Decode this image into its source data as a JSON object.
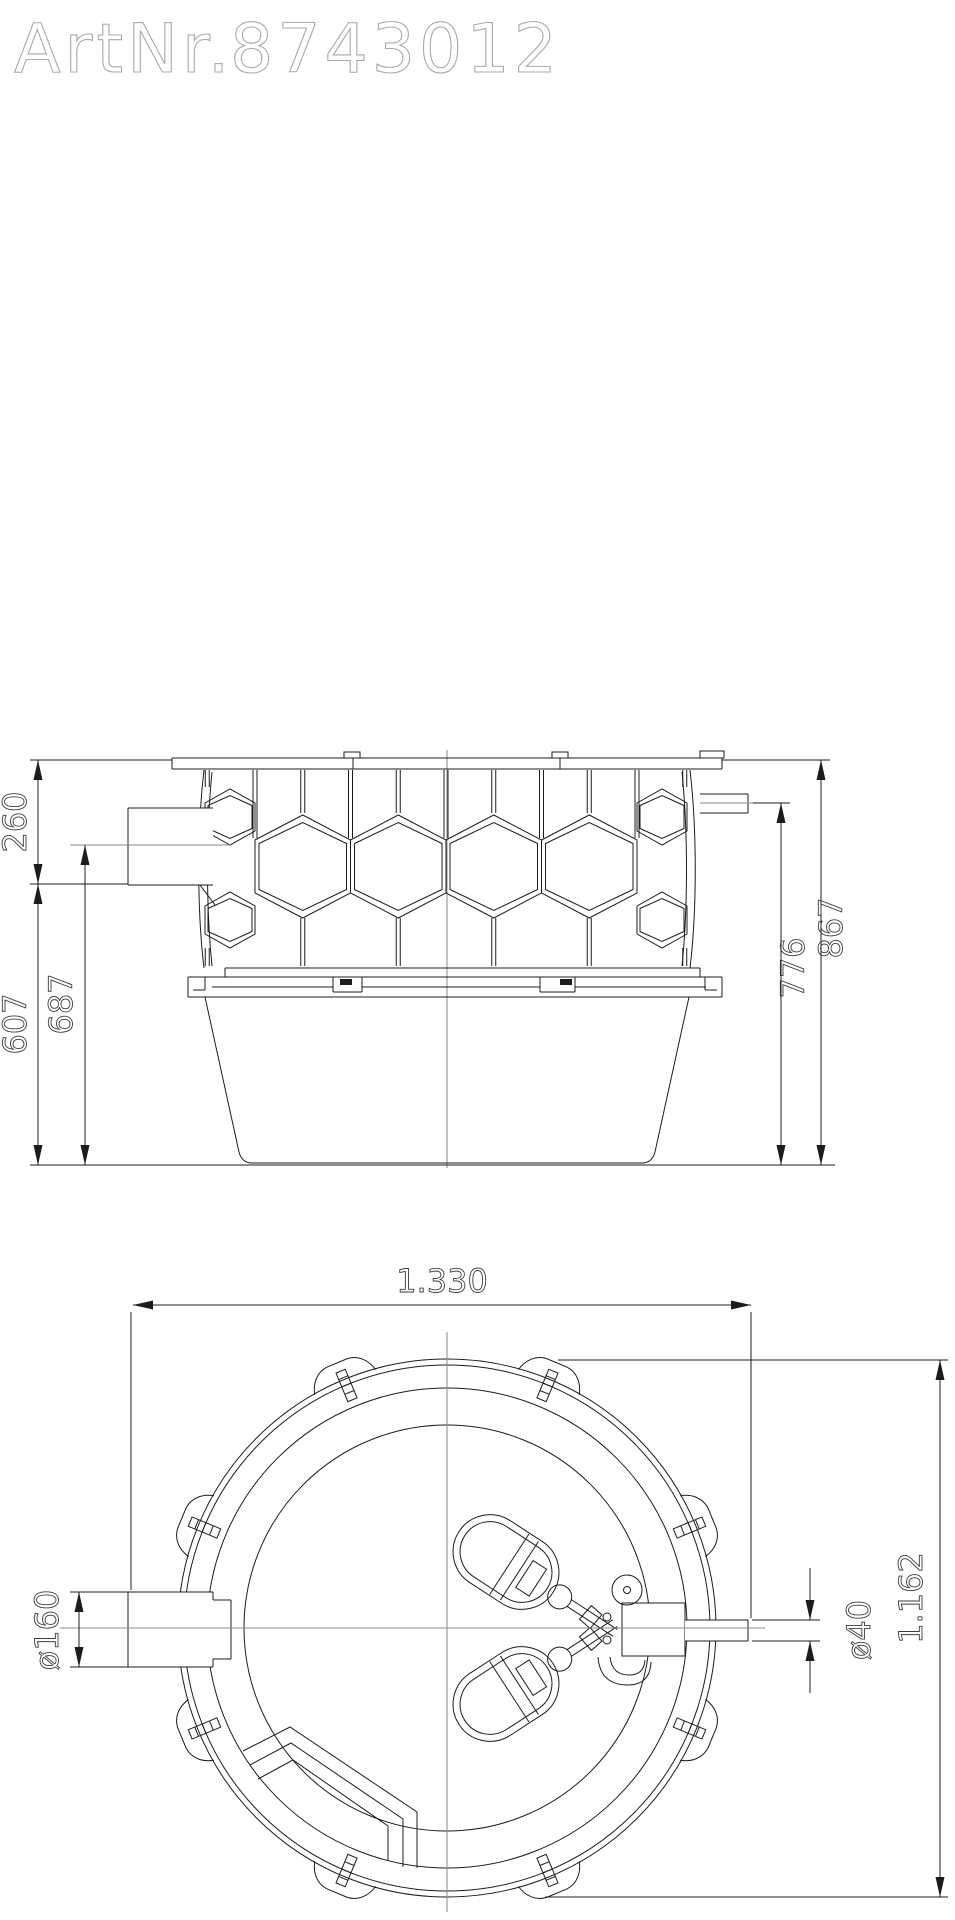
{
  "title": {
    "label": "ArtNr.",
    "number": "8743012"
  },
  "side_view": {
    "caption": "side-elevation-of-tank",
    "dim_inlet_top_offset": "260",
    "dim_below_inlet_height": "607",
    "dim_inlet_center_height": "687",
    "dim_outlet_center_height": "776",
    "dim_total_height": "867"
  },
  "plan_view": {
    "caption": "top-view-of-tank",
    "dim_overall_width": "1.330",
    "dim_inlet_diameter": "ø160",
    "dim_outlet_diameter": "ø40",
    "dim_tank_diameter": "1.162"
  },
  "colors": {
    "line": "#1c1c1c",
    "centerline": "#8a8a8a",
    "dim_text": "#3c3c3c",
    "title_stroke": "#a9a9a9",
    "background": "#ffffff"
  }
}
